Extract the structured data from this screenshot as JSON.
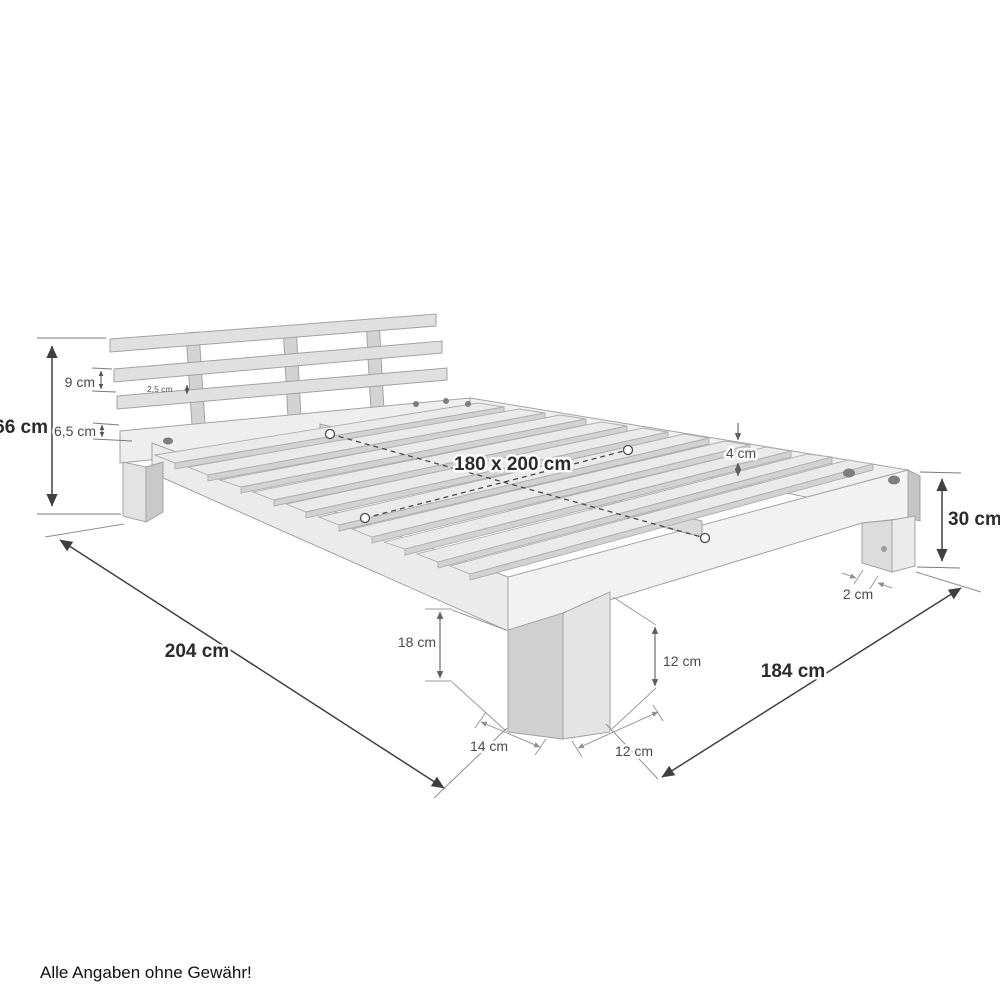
{
  "diagram": {
    "type": "product-dimension-diagram",
    "subject": "wooden slatted bed frame with headboard",
    "footnote": "Alle Angaben ohne Gewähr!",
    "dimensions": {
      "total_height": "66 cm",
      "headboard_board": "9 cm",
      "headboard_gap": "6,5 cm",
      "headboard_thickness": "2,5 cm",
      "lying_surface": "180 x 200 cm",
      "slat_thickness": "4 cm",
      "frame_height": "30 cm",
      "foot_inset": "2 cm",
      "underbed_clearance": "18 cm",
      "leg_front_height": "12 cm",
      "leg_depth": "14 cm",
      "leg_width": "12 cm",
      "total_length": "204 cm",
      "total_width": "184 cm"
    },
    "colors": {
      "background": "#ffffff",
      "wood_light": "#efefef",
      "wood_mid": "#e0e0e0",
      "wood_shade": "#cfcfcf",
      "outline": "#a2a2a2",
      "dimension_dark": "#3f3f3f",
      "dimension_gray": "#9b9b9b",
      "text_dark": "#2b2b2b",
      "text_gray": "#4a4a4a"
    }
  }
}
